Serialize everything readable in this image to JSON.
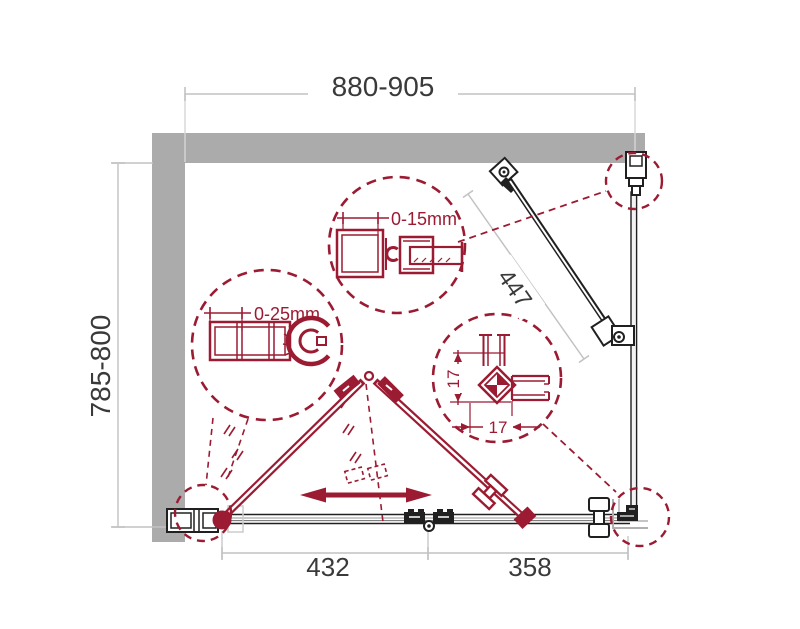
{
  "page": {
    "background": "#ffffff"
  },
  "diagram": {
    "type": "shower-enclosure-plan-technical-drawing",
    "colors": {
      "accent_red": "#9b1b32",
      "line_black": "#202020",
      "wall_gray": "#ababab",
      "dim_line_gray": "#c2c2c2",
      "dim_text": "#3a3a3a"
    },
    "dimensions": {
      "width_range": "880-905",
      "depth_range": "785-800",
      "support_bar_length": "447",
      "left_panel_width": "432",
      "right_panel_width": "358"
    },
    "details": {
      "wall_profile_adjustment": "0-15mm",
      "pivot_profile_adjustment": "0-25mm",
      "corner_profile_height": "17",
      "corner_profile_width": "17"
    }
  }
}
